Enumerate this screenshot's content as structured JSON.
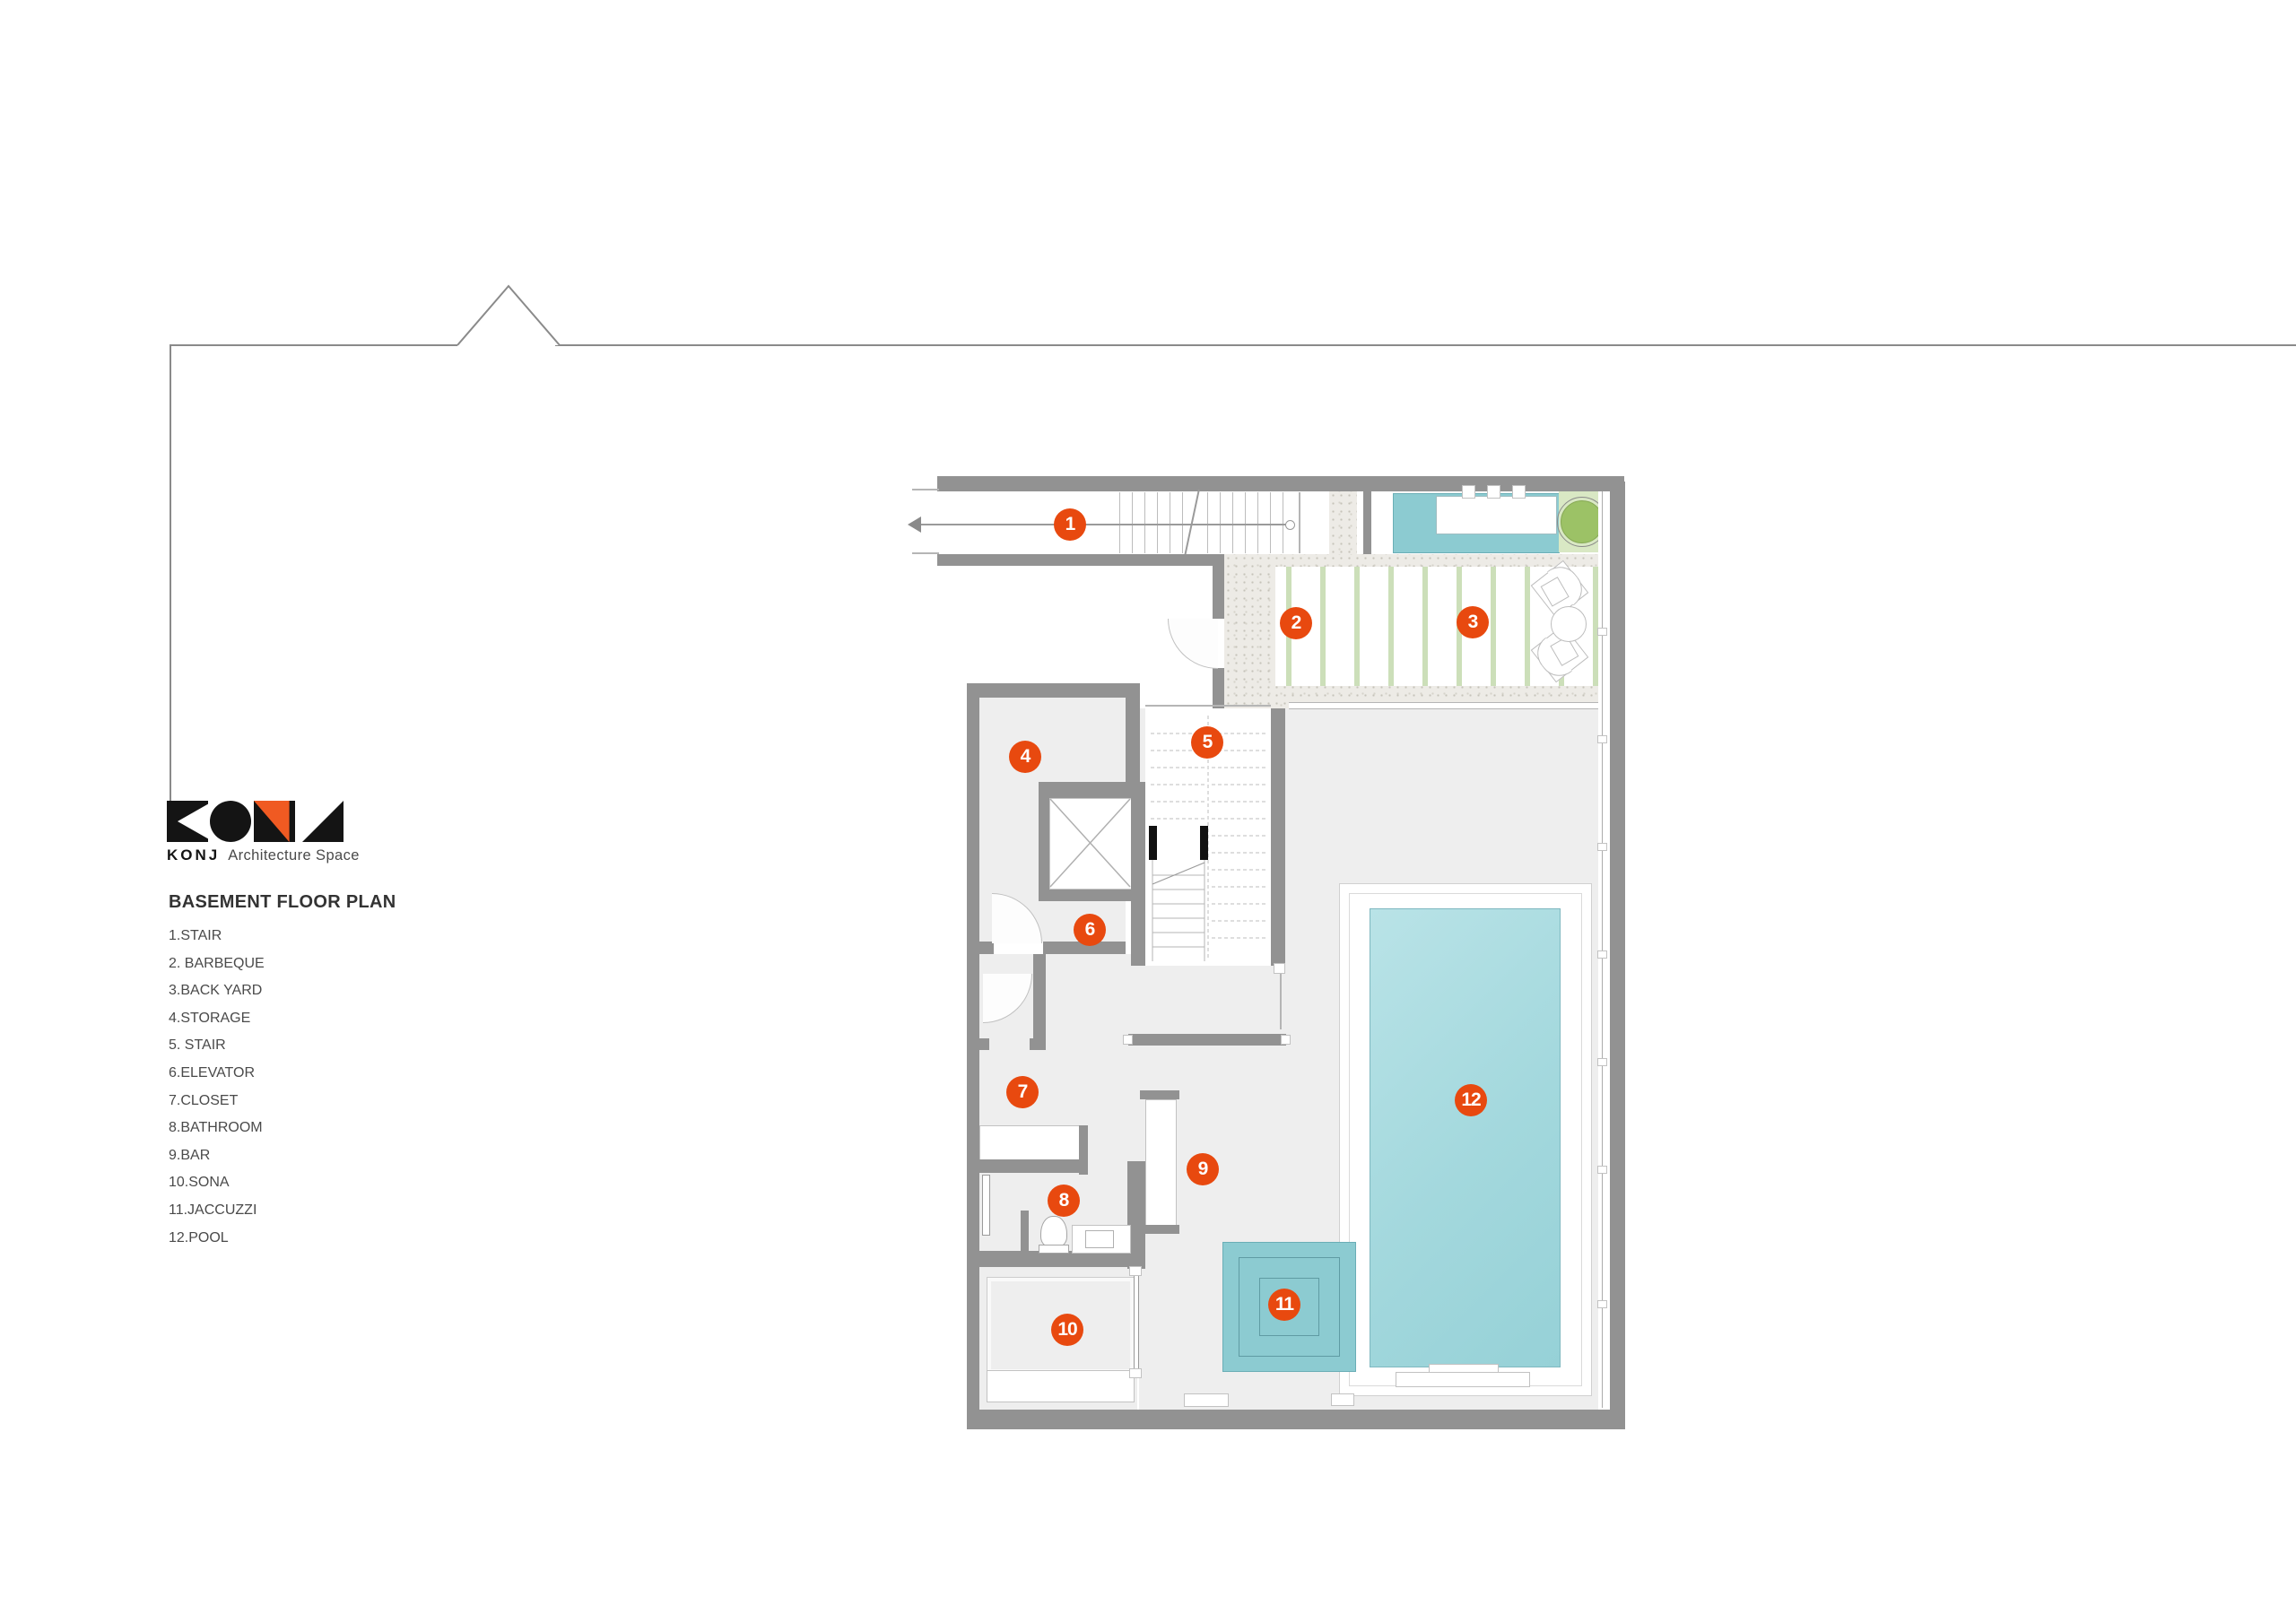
{
  "brand": {
    "name": "KONJ",
    "tagline": "Architecture Space",
    "accent_color": "#f05a22",
    "logo_color": "#141414"
  },
  "legend": {
    "title": "BASEMENT FLOOR PLAN",
    "items": [
      "1.STAIR",
      "2. BARBEQUE",
      "3.BACK YARD",
      "4.STORAGE",
      "5. STAIR",
      "6.ELEVATOR",
      "7.CLOSET",
      "8.BATHROOM",
      "9.BAR",
      "10.SONA",
      "11.JACCUZZI",
      "12.POOL"
    ]
  },
  "markers": [
    {
      "number": "1",
      "room": "stair"
    },
    {
      "number": "2",
      "room": "barbeque"
    },
    {
      "number": "3",
      "room": "back yard"
    },
    {
      "number": "4",
      "room": "storage"
    },
    {
      "number": "5",
      "room": "stair"
    },
    {
      "number": "6",
      "room": "elevator"
    },
    {
      "number": "7",
      "room": "closet"
    },
    {
      "number": "8",
      "room": "bathroom"
    },
    {
      "number": "9",
      "room": "bar"
    },
    {
      "number": "10",
      "room": "sona"
    },
    {
      "number": "11",
      "room": "jaccuzzi"
    },
    {
      "number": "12",
      "room": "pool"
    }
  ],
  "colors": {
    "marker": "#e8490f",
    "wall": "#929292",
    "floor": "#eeeeee",
    "pool_water": "#a3d8dd",
    "fixture_teal": "#8ccbd1",
    "stripe_green": "#ccdfb9",
    "tree_green": "#9cc266",
    "planter_green": "#d9e8c4"
  }
}
